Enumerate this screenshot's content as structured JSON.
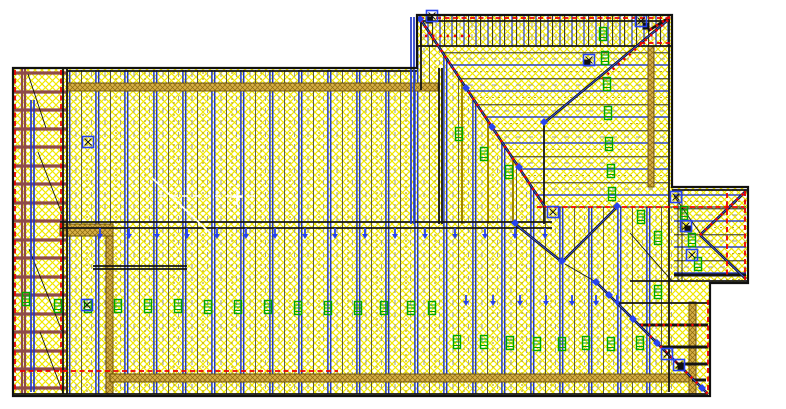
{
  "document": {
    "description": "CAD roof truss framing placement plan viewport",
    "visible_text": []
  },
  "colors": {
    "background": "#ffffff",
    "hatch_yellow": "#f0e800",
    "line_black": "#141414",
    "line_blue": "#2038c8",
    "marker_blue": "#2743f0",
    "line_olive": "#a08500",
    "line_gray": "#9a9a9a",
    "bearing_red": "#ee0000",
    "ladder_brown": "#8e4a4a",
    "wall_tan": "#d6ae45",
    "wall_tan_dark": "#6b520e",
    "highlight_white": "#ffffff",
    "marker_green": "#00a800"
  },
  "drawing": {
    "outline": "M13,68 H417 V15 H672 V187 H748 V283 H710 V396 H13 Z",
    "fills": [
      {
        "d": "M13,68 H417 V15 H672 V187 H748 V283 H710 V396 H13 Z",
        "fill": "#ffffff"
      },
      {
        "d": "M13,68 H417 V15 H672 V187 H748 V283 H710 V396 H13 Z",
        "fill": "url(#hatch)"
      },
      {
        "d": "M67,70 H417 V394 H67 Z",
        "fill": "url(#vtruss)"
      },
      {
        "d": "M418,16 H671 V46 H418 Z",
        "fill": "url(#vtruss2)"
      },
      {
        "d": "M417,46 H438 L545,207 H417 Z",
        "fill": "url(#vtruss)"
      },
      {
        "d": "M417,207 H672 V394 H417 Z",
        "fill": "url(#vtruss)"
      },
      {
        "d": "M438,46 H668 V207 H545 Z",
        "fill": "#ffffff"
      },
      {
        "d": "M438,46 H668 V207 H545 Z",
        "fill": "url(#hatch)"
      },
      {
        "d": "M438,46 H668 V207 H545 Z",
        "fill": "url(#htruss)"
      },
      {
        "d": "M674,189 H746 V281 H674 Z",
        "fill": "#ffffff"
      },
      {
        "d": "M674,189 H746 V281 H674 Z",
        "fill": "url(#hatch)"
      },
      {
        "d": "M674,189 H746 V281 H674 Z",
        "fill": "url(#htruss)"
      }
    ],
    "tanRects": [
      [
        67,
        83,
        371,
        8
      ],
      [
        60,
        224,
        53,
        12
      ],
      [
        106,
        236,
        7,
        158
      ],
      [
        110,
        374,
        582,
        8
      ],
      [
        648,
        46,
        6,
        141
      ],
      [
        689,
        302,
        7,
        92
      ]
    ],
    "ladder": {
      "rungYs": [
        73,
        92,
        110,
        129,
        147,
        166,
        184,
        203,
        221,
        240,
        258,
        277,
        295,
        314,
        332,
        351,
        369,
        388
      ],
      "rungX1": 14,
      "rungX2": 66,
      "rails": [
        [
          22,
          68,
          22,
          394
        ],
        [
          25,
          68,
          25,
          394
        ]
      ]
    },
    "layers": [
      {
        "name": "olive-jack-trusses",
        "stroke": "#a08500",
        "w": 2,
        "segs": [
          [
            462,
            84,
            462,
            224
          ],
          [
            488,
            122,
            488,
            224
          ],
          [
            513,
            160,
            513,
            224
          ]
        ]
      },
      {
        "name": "thin-black-lines",
        "stroke": "#141414",
        "w": 0.9,
        "segs": [
          [
            28,
            74,
            46,
            128
          ],
          [
            38,
            152,
            62,
            214
          ],
          [
            29,
            249,
            62,
            331
          ],
          [
            40,
            332,
            63,
            393
          ],
          [
            630,
            233,
            672,
            281
          ],
          [
            565,
            264,
            596,
            282
          ],
          [
            674,
            196,
            700,
            233
          ],
          [
            678,
            190,
            678,
            281
          ],
          [
            682,
            190,
            682,
            281
          ],
          [
            537,
            207,
            746,
            207
          ]
        ]
      },
      {
        "name": "medium-black-lines",
        "stroke": "#141414",
        "w": 1.8,
        "segs": [
          [
            67,
            71,
            417,
            71
          ],
          [
            421,
            19,
            421,
            90
          ],
          [
            439,
            68,
            439,
            224
          ],
          [
            442,
            68,
            442,
            224
          ],
          [
            544,
            122,
            544,
            224
          ],
          [
            669,
            17,
            669,
            392
          ],
          [
            419,
            21,
            670,
            21
          ],
          [
            417,
            46,
            672,
            46
          ],
          [
            60,
            222,
            552,
            222
          ],
          [
            60,
            228,
            552,
            228
          ],
          [
            93,
            266,
            187,
            266
          ],
          [
            93,
            269,
            187,
            269
          ],
          [
            14,
            394,
            708,
            394
          ],
          [
            63,
            68,
            63,
            394
          ],
          [
            67,
            68,
            67,
            394
          ],
          [
            672,
            190,
            748,
            190
          ],
          [
            630,
            281,
            748,
            281
          ],
          [
            617,
            303,
            710,
            303
          ]
        ]
      },
      {
        "name": "jack-bars",
        "stroke": "#141414",
        "w": 3,
        "segs": [
          [
            639,
            325,
            708,
            325
          ],
          [
            661,
            347,
            708,
            347
          ],
          [
            678,
            364,
            708,
            364
          ],
          [
            692,
            380,
            706,
            380
          ],
          [
            674,
            275,
            746,
            275
          ]
        ]
      },
      {
        "name": "blue-walls",
        "stroke": "#2038c8",
        "w": 1.7,
        "segs": [
          [
            411,
            17,
            411,
            224
          ],
          [
            414,
            17,
            414,
            224
          ],
          [
            31,
            100,
            31,
            392
          ],
          [
            34,
            100,
            34,
            392
          ]
        ]
      },
      {
        "name": "valley-hip-lines",
        "stroke": "#141414",
        "w": 2.6,
        "segs": [
          [
            421,
            20,
            545,
            207
          ],
          [
            668,
            20,
            544,
            123
          ],
          [
            596,
            282,
            708,
            394
          ],
          [
            515,
            224,
            562,
            262
          ],
          [
            562,
            262,
            617,
            207
          ],
          [
            746,
            191,
            700,
            235
          ],
          [
            746,
            279,
            700,
            235
          ],
          [
            670,
            17,
            648,
            31
          ]
        ]
      },
      {
        "name": "valley-hip-core",
        "stroke": "#3a55e8",
        "w": 0.9,
        "segs": [
          [
            421,
            20,
            545,
            207
          ],
          [
            668,
            20,
            544,
            123
          ],
          [
            596,
            282,
            708,
            394
          ],
          [
            515,
            224,
            562,
            262
          ],
          [
            562,
            262,
            617,
            207
          ],
          [
            746,
            191,
            700,
            235
          ],
          [
            746,
            279,
            700,
            235
          ]
        ]
      },
      {
        "name": "bearing-red-dashed",
        "stroke": "#ee0000",
        "w": 1.8,
        "dash": "5,3.5",
        "segs": [
          [
            15,
            70,
            15,
            392
          ],
          [
            61,
            70,
            61,
            392
          ],
          [
            419,
            18,
            670,
            18
          ],
          [
            537,
            207,
            744,
            207
          ],
          [
            20,
            371,
            338,
            371
          ],
          [
            727,
            193,
            727,
            277
          ],
          [
            745,
            191,
            745,
            280
          ],
          [
            708,
            300,
            708,
            392
          ],
          [
            640,
            43,
            670,
            43
          ]
        ]
      },
      {
        "name": "bearing-red-dots",
        "stroke": "#ee0000",
        "w": 2.6,
        "dash": "2.2,5",
        "segs": [
          [
            421,
            20,
            545,
            207
          ],
          [
            668,
            20,
            600,
            81
          ],
          [
            650,
            336,
            708,
            394
          ],
          [
            641,
            325,
            704,
            325
          ],
          [
            425,
            36,
            470,
            36
          ],
          [
            670,
            17,
            648,
            31
          ],
          [
            700,
            235,
            744,
            193
          ]
        ]
      },
      {
        "name": "highlight-white-solid",
        "stroke": "#ffffff",
        "w": 1.6,
        "segs": [
          [
            152,
            178,
            210,
            233
          ],
          [
            237,
            189,
            237,
            205
          ],
          [
            232,
            197,
            242,
            197
          ]
        ]
      },
      {
        "name": "highlight-white-dashed",
        "stroke": "#ffffff",
        "w": 1.6,
        "dash": "6,5",
        "segs": [
          [
            188,
            164,
            188,
            198
          ],
          [
            160,
            196,
            256,
            196
          ]
        ]
      }
    ],
    "markers": {
      "hanger_green": [
        [
          26,
          299
        ],
        [
          58,
          306
        ],
        [
          88,
          306
        ],
        [
          118,
          306
        ],
        [
          148,
          306
        ],
        [
          178,
          306
        ],
        [
          208,
          307
        ],
        [
          238,
          307
        ],
        [
          268,
          307
        ],
        [
          298,
          308
        ],
        [
          328,
          308
        ],
        [
          358,
          308
        ],
        [
          384,
          308
        ],
        [
          411,
          308
        ],
        [
          432,
          308
        ],
        [
          457,
          342
        ],
        [
          484,
          342
        ],
        [
          510,
          343
        ],
        [
          537,
          344
        ],
        [
          562,
          344
        ],
        [
          586,
          343
        ],
        [
          611,
          344
        ],
        [
          640,
          343
        ],
        [
          603,
          34
        ],
        [
          605,
          58
        ],
        [
          607,
          84
        ],
        [
          608,
          113
        ],
        [
          609,
          144
        ],
        [
          611,
          171
        ],
        [
          612,
          194
        ],
        [
          459,
          134
        ],
        [
          484,
          154
        ],
        [
          509,
          172
        ],
        [
          641,
          217
        ],
        [
          658,
          238
        ],
        [
          658,
          292
        ],
        [
          684,
          213
        ],
        [
          692,
          240
        ],
        [
          698,
          264
        ]
      ],
      "connector_blue_squares": [
        [
          432,
          16
        ],
        [
          589,
          60
        ],
        [
          641,
          21
        ],
        [
          676,
          197
        ],
        [
          686,
          226
        ],
        [
          692,
          255
        ],
        [
          667,
          354
        ],
        [
          679,
          365
        ],
        [
          88,
          142
        ],
        [
          87,
          305
        ],
        [
          553,
          212
        ]
      ],
      "black_squares": [
        [
          429,
          20
        ],
        [
          587,
          63
        ],
        [
          646,
          26
        ],
        [
          688,
          229
        ],
        [
          681,
          367
        ]
      ],
      "node_blue_diamonds": [
        [
          544,
          122
        ],
        [
          515,
          223
        ],
        [
          562,
          261
        ],
        [
          617,
          206
        ],
        [
          466,
          88
        ],
        [
          492,
          127
        ],
        [
          519,
          167
        ],
        [
          596,
          282
        ],
        [
          609,
          295
        ],
        [
          633,
          319
        ],
        [
          657,
          343
        ],
        [
          702,
          388
        ],
        [
          420,
          19
        ]
      ],
      "bearing_arrow_rows": [
        {
          "y": 233,
          "xs": [
            100,
            129,
            157,
            187,
            217,
            246,
            275,
            305,
            335,
            365,
            395,
            425,
            455,
            485,
            515,
            545
          ]
        },
        {
          "y": 300,
          "xs": [
            466,
            493,
            520,
            546,
            572,
            596,
            617
          ]
        }
      ]
    }
  }
}
